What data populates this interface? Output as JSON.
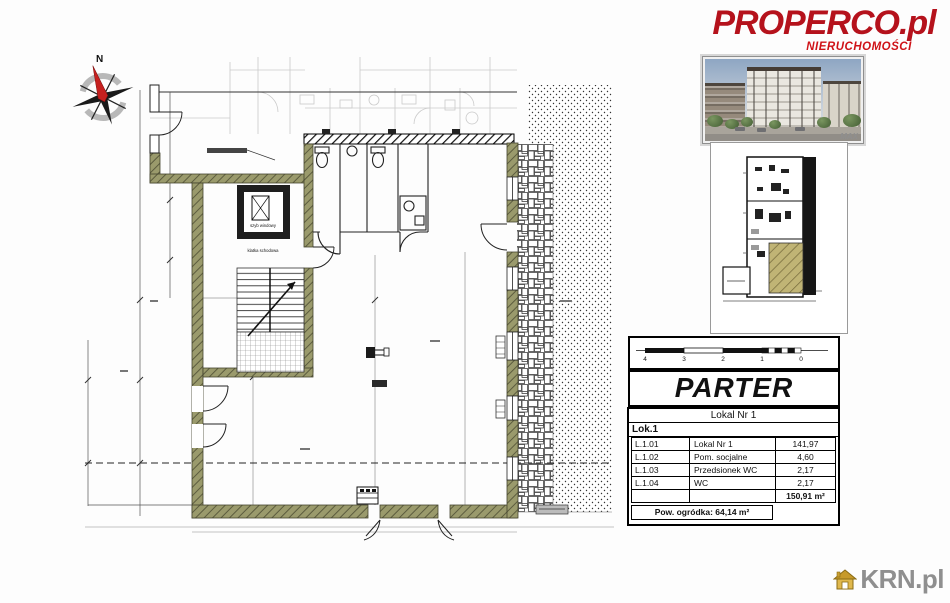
{
  "branding": {
    "properco_name": "PROPERCO.pl",
    "properco_tagline": "NIERUCHOMOŚCI",
    "properco_color": "#b5121c",
    "krn_name": "KRN.pl",
    "krn_text_color": "#8f8f8f",
    "krn_house_color": "#dfae3a"
  },
  "photo": {
    "watermark": "MAX"
  },
  "plan": {
    "compass_label": "N",
    "elevator_label": "szyb windowy",
    "stairs_label": "klatka schodowa",
    "wall_color": "#9a9a6c"
  },
  "titleblock": {
    "title": "PARTER",
    "scale_ticks": [
      "4",
      "3",
      "2",
      "1",
      "0"
    ]
  },
  "table": {
    "header": "Lokal Nr 1",
    "group": "Lok.1",
    "rows": [
      {
        "code": "L.1.01",
        "name": "Lokal Nr 1",
        "area": "141,97"
      },
      {
        "code": "L.1.02",
        "name": "Pom. socjalne",
        "area": "4,60"
      },
      {
        "code": "L.1.03",
        "name": "Przedsionek WC",
        "area": "2,17"
      },
      {
        "code": "L.1.04",
        "name": "WC",
        "area": "2,17"
      }
    ],
    "total_area": "150,91 m²",
    "garden_label": "Pow. ogródka: 64,14 m²"
  }
}
